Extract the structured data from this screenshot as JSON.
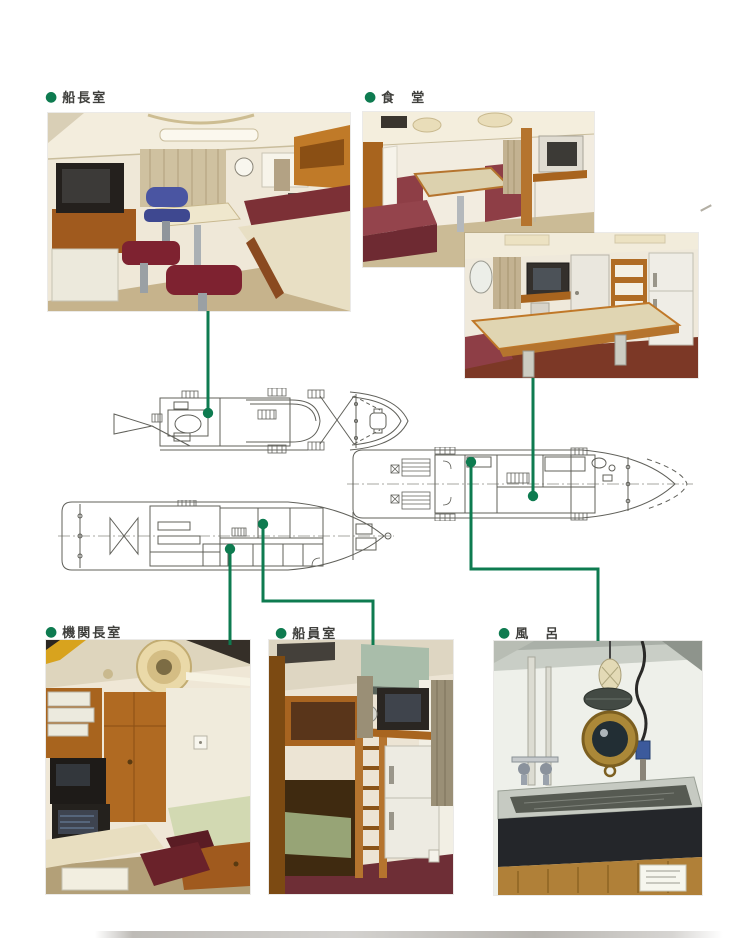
{
  "page": {
    "background": "#ffffff",
    "accent_green": "#0e7b50",
    "label_text_color": "#3f3f3c"
  },
  "icons": {
    "section_bullet": "●"
  },
  "sections": {
    "captain": {
      "label": "船長室"
    },
    "dining": {
      "label": "食　堂"
    },
    "engineer": {
      "label": "機関長室"
    },
    "crew": {
      "label": "船員室"
    },
    "bath": {
      "label": "風　呂"
    }
  }
}
